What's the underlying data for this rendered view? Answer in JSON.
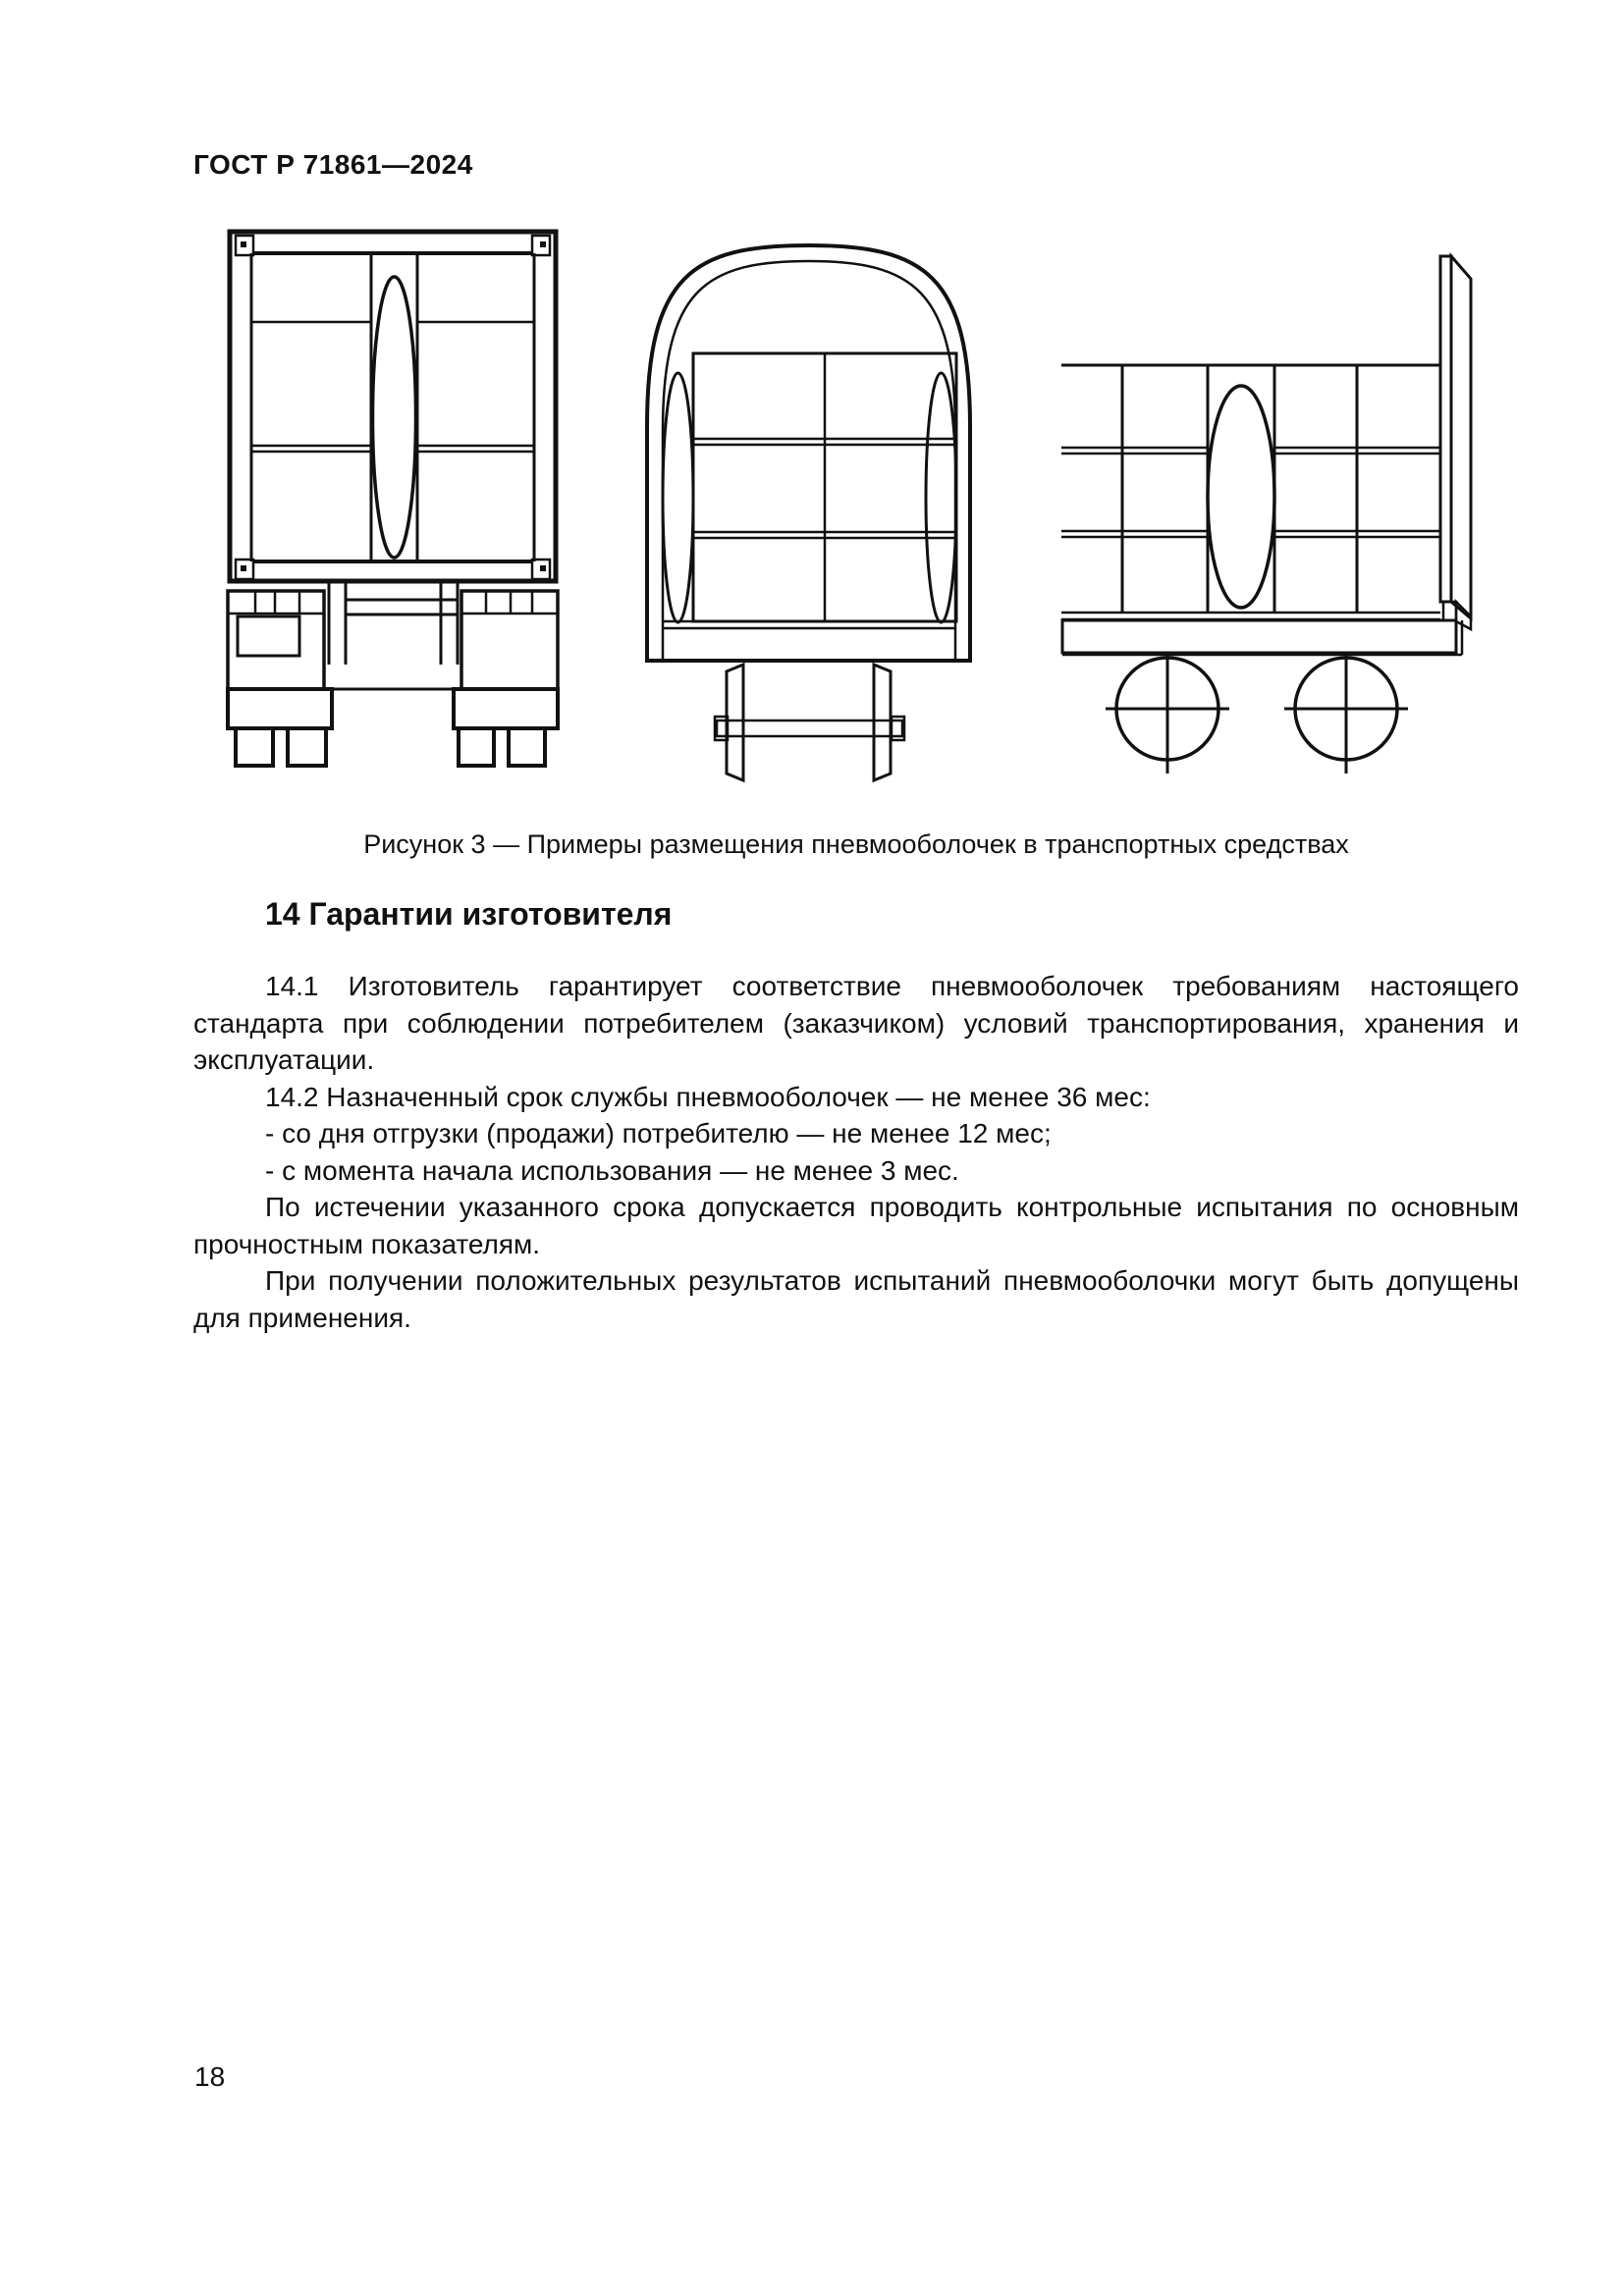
{
  "page": {
    "header": "ГОСТ Р 71861—2024",
    "page_number": "18"
  },
  "figure": {
    "caption": "Рисунок 3 — Примеры размещения пневмооболочек в транспортных средствах",
    "drawing_names": [
      "truck-rear-view-with-container-and-pneumatic-shell",
      "railcar-cross-section-with-cargo-and-side-pneumatic-shells",
      "platform-car-side-view-with-cargo-and-pneumatic-shell"
    ]
  },
  "section": {
    "heading": "14 Гарантии изготовителя",
    "paragraphs": [
      "14.1 Изготовитель гарантирует соответствие пневмооболочек требованиям настоящего стандарта при соблюдении потребителем (заказчиком) условий транспортирования, хранения и эксплуатации.",
      "14.2 Назначенный срок службы пневмооболочек — не менее 36 мес:",
      "- со дня отгрузки (продажи) потребителю — не менее 12 мес;",
      "- с момента начала использования — не менее 3 мес.",
      "По истечении указанного срока допускается проводить контрольные испытания по основным прочностным показателям.",
      "При получении положительных результатов испытаний пневмооболочки могут быть допущены для применения."
    ]
  }
}
